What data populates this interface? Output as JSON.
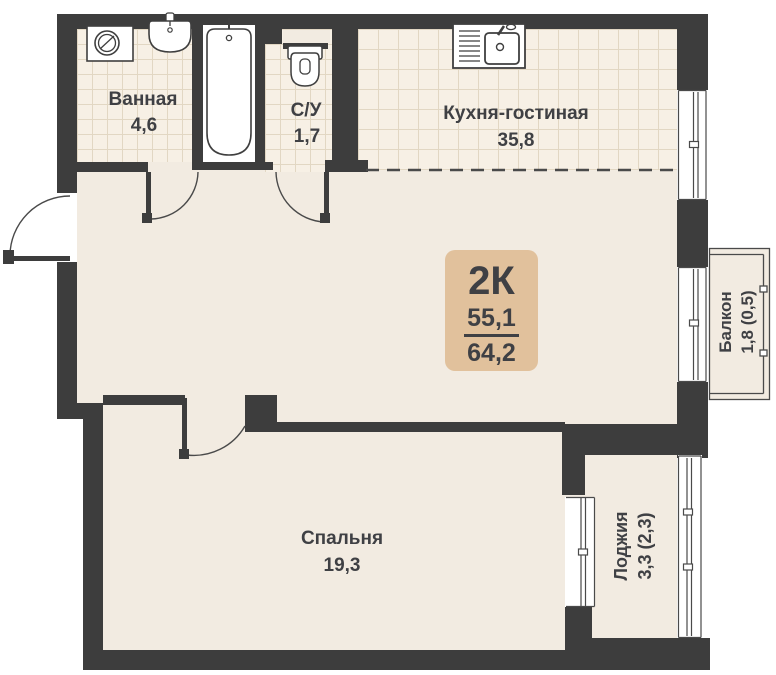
{
  "meta": {
    "plan_type_label": "2К",
    "area_living": "55,1",
    "area_total": "64,2"
  },
  "rooms": {
    "bathroom": {
      "name": "Ванная",
      "area": "4,6"
    },
    "toilet": {
      "name": "С/У",
      "area": "1,7"
    },
    "kitchen_living": {
      "name": "Кухня-гостиная",
      "area": "35,8"
    },
    "bedroom": {
      "name": "Спальня",
      "area": "19,3"
    },
    "balcony": {
      "name": "Балкон",
      "area": "1,8 (0,5)"
    },
    "loggia": {
      "name": "Лоджия",
      "area": "3,3 (2,3)"
    }
  },
  "colors": {
    "wall": "#3d3d3d",
    "floor": "#f2ebe1",
    "tile_floor": "#f7f0e5",
    "tile_line": "#e2d7c3",
    "badge_bg": "#e1c19c",
    "text": "#3f4044",
    "fixture_outline": "#3f3f3f",
    "background": "#ffffff"
  },
  "icons": {
    "washing_machine": "washing-machine-icon",
    "bathroom_sink": "bathroom-sink-icon",
    "bathtub": "bathtub-icon",
    "toilet": "toilet-icon",
    "kitchen_sink": "kitchen-sink-icon"
  }
}
